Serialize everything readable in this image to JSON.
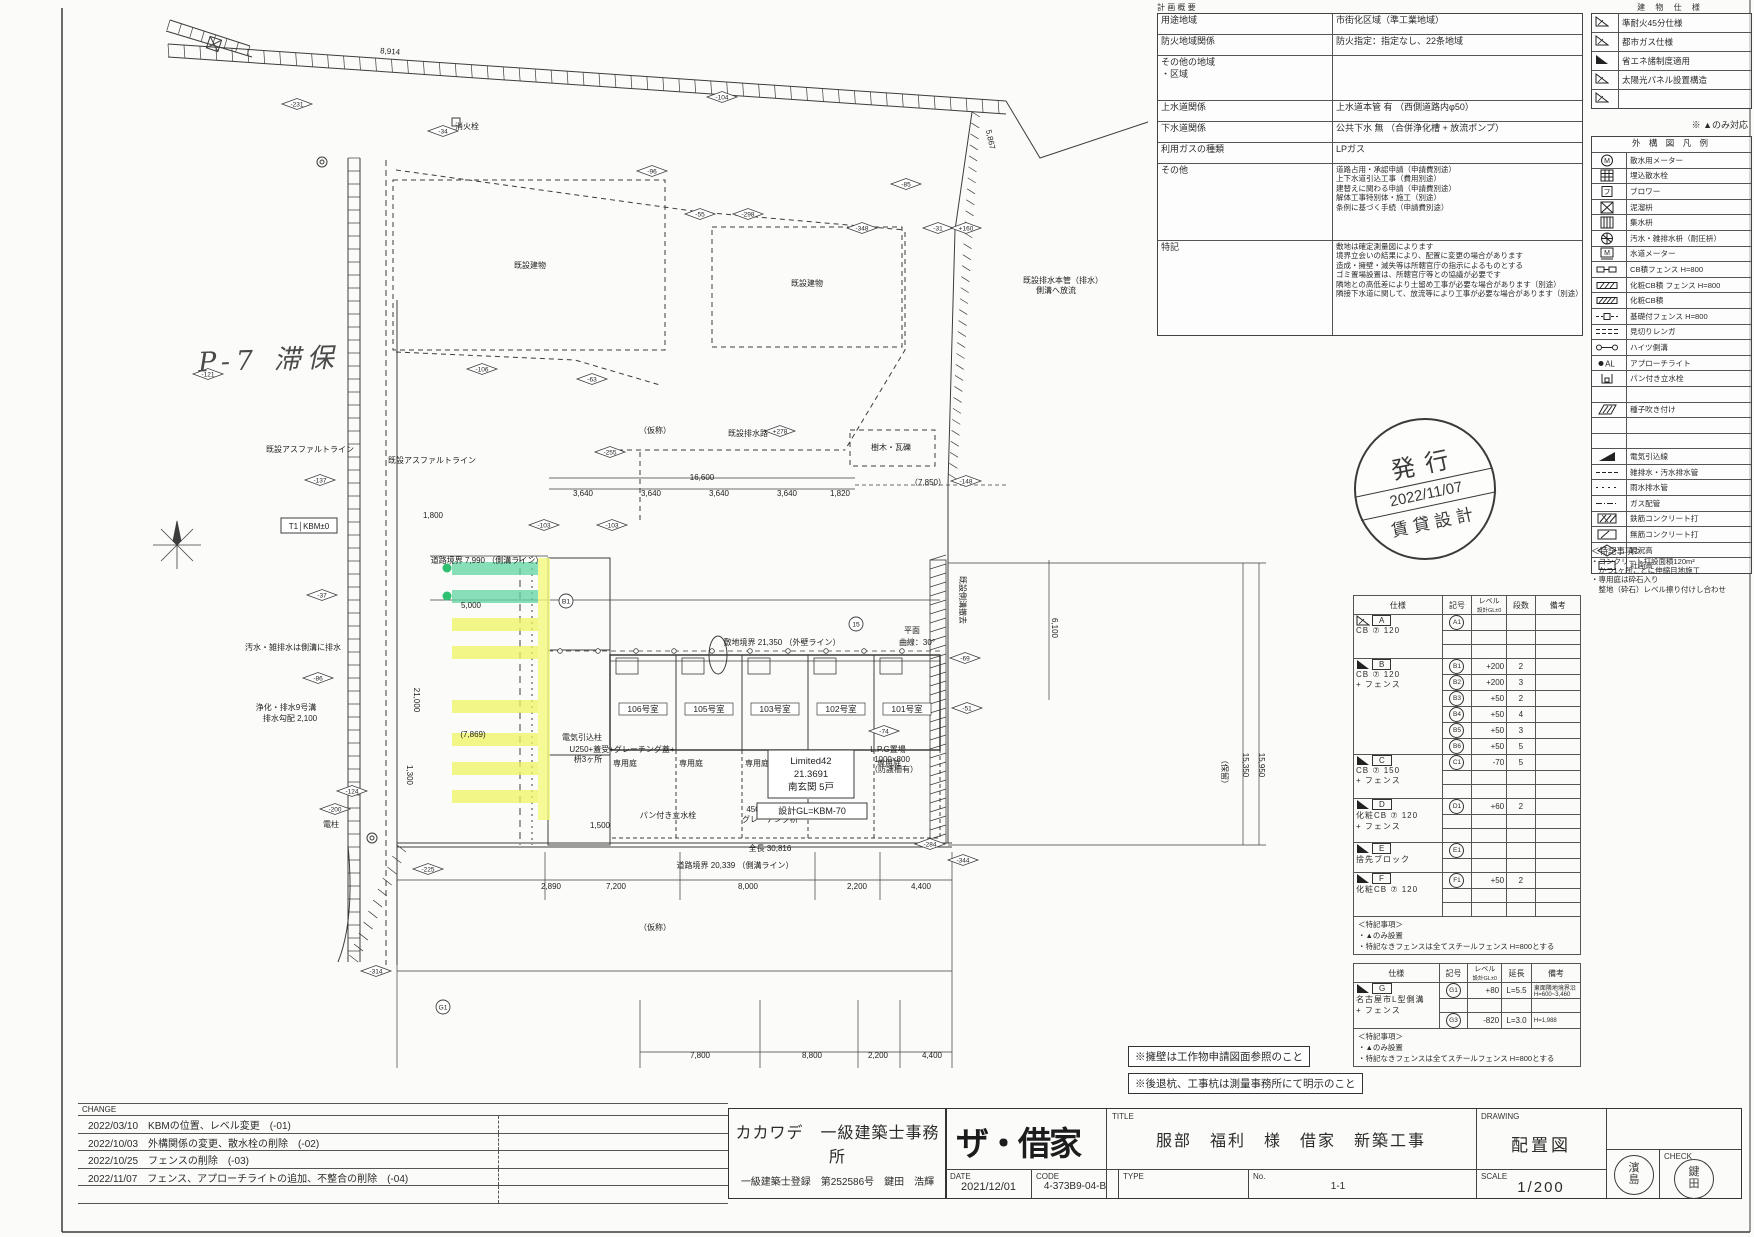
{
  "overview_table": {
    "title": "計 画 概 要",
    "rows": [
      {
        "label": "用途地域",
        "lines": [
          "市街化区域（準工業地域）"
        ]
      },
      {
        "label": "防火地域関係",
        "lines": [
          "防火指定：指定なし、22条地域"
        ]
      },
      {
        "label": "その他の地域\n・区域",
        "lines": []
      },
      {
        "label": "上水道関係",
        "lines": [
          "上水道本管 有 （西側道路内φ50）"
        ]
      },
      {
        "label": "下水道関係",
        "lines": [
          "公共下水 無 （合併浄化槽 + 放流ポンプ）"
        ]
      },
      {
        "label": "利用ガスの種類",
        "lines": [
          "LPガス"
        ]
      },
      {
        "label": "その他",
        "lines": [
          "道路占用・承認申請（申請費別途）",
          "上下水道引込工事（費用別途）",
          "建替えに関わる申請（申請費別途）",
          "解体工事特別体・施工（別途）",
          "条例に基づく手続（申請費別途）"
        ]
      },
      {
        "label": "特記",
        "lines": [
          "敷地は確定測量図によります",
          "境界立会いの結果により、配置に変更の場合があります",
          "造成・擁壁・滅失等は所轄官庁の指示によるものとする",
          "ゴミ置場設置は、所轄官庁等との協議が必要です",
          "隣地との高低差により土留め工事が必要な場合があります（別途）",
          "隣接下水道に関して、放流等により工事が必要な場合があります（別途）"
        ]
      }
    ]
  },
  "building_spec": {
    "title": "建 物 仕 様",
    "items": [
      {
        "mark": "hatch",
        "label": "準耐火45分仕様"
      },
      {
        "mark": "hatch",
        "label": "都市ガス仕様"
      },
      {
        "mark": "solid",
        "label": "省エネ諸制度適用"
      },
      {
        "mark": "hatch",
        "label": "太陽光パネル設置構造"
      },
      {
        "mark": "hatch",
        "label": ""
      }
    ],
    "note": "※ ▲のみ対応"
  },
  "legend": {
    "title": "外 構 図 凡 例",
    "rows": [
      {
        "icon": "meter-icon",
        "label": "散水用メーター"
      },
      {
        "icon": "sprinkler-icon",
        "label": "埋込散水栓"
      },
      {
        "icon": "blower-icon",
        "label": "ブロワー"
      },
      {
        "icon": "mud-basin-icon",
        "label": "泥溜枡"
      },
      {
        "icon": "catch-basin-icon",
        "label": "集水枡"
      },
      {
        "icon": "sewer-basin-icon",
        "label": "汚水・雑排水枡（耐圧枡）"
      },
      {
        "icon": "water-meter-icon",
        "label": "水道メーター"
      },
      {
        "icon": "cb-fence-icon",
        "label": "CB積フェンス H=800"
      },
      {
        "icon": "deco-cb-fence-icon",
        "label": "化粧CB積 フェンス H=800"
      },
      {
        "icon": "deco-cb-icon",
        "label": "化粧CB積"
      },
      {
        "icon": "base-fence-icon",
        "label": "基礎付フェンス H=800"
      },
      {
        "icon": "brick-edge-icon",
        "label": "見切りレンガ"
      },
      {
        "icon": "gutter-icon",
        "label": "ハイツ側溝"
      },
      {
        "icon": "approach-light-icon",
        "label": "アプローチライト"
      },
      {
        "icon": "faucet-icon",
        "label": "パン付き立水栓"
      },
      {
        "icon": "",
        "label": ""
      },
      {
        "icon": "seed-icon",
        "label": "種子吹き付け"
      },
      {
        "icon": "",
        "label": ""
      },
      {
        "icon": "",
        "label": ""
      },
      {
        "icon": "power-line-icon",
        "label": "電気引込線"
      },
      {
        "icon": "drain-pipe-icon",
        "label": "雑排水・汚水排水管"
      },
      {
        "icon": "rain-pipe-icon",
        "label": "雨水排水管"
      },
      {
        "icon": "gas-pipe-icon",
        "label": "ガス配管"
      },
      {
        "icon": "rc-icon",
        "label": "鉄筋コンクリート打"
      },
      {
        "icon": "plain-rc-icon",
        "label": "無筋コンクリート打"
      },
      {
        "icon": "existing-level-icon",
        "label": "現況高"
      },
      {
        "icon": "plan-level-icon",
        "label": "計画高"
      }
    ],
    "notes_title": "＜特記事項＞",
    "notes": [
      "・コンクリート打設面積120m²",
      "　かつ1ヶ所ごとに伸縮目地施工",
      "・専用庭は砕石入り",
      "　整地（砕石）レベル擦り付けし合わせ"
    ]
  },
  "issue_stamp": {
    "line1": "発行",
    "line2": "2022/11/07",
    "line3": "賃貸設計"
  },
  "spec_table": {
    "headers": [
      "仕様",
      "記号",
      "レベル|設計GL±0",
      "段数",
      "備考"
    ],
    "groups": [
      {
        "mark": "A",
        "tri": "hatch",
        "spec": [
          "CB ⑦ 120"
        ],
        "rows": [
          {
            "sym": "A1",
            "lv": "",
            "dan": "",
            "biko": []
          },
          {},
          {}
        ]
      },
      {
        "mark": "B",
        "tri": "solid",
        "spec": [
          "CB ⑦ 120",
          "+ フェンス"
        ],
        "rows": [
          {
            "sym": "B1",
            "lv": "+200",
            "dan": "2",
            "biko": []
          },
          {
            "sym": "B2",
            "lv": "+200",
            "dan": "3",
            "biko": []
          },
          {
            "sym": "B3",
            "lv": "+50",
            "dan": "2",
            "biko": []
          },
          {
            "sym": "B4",
            "lv": "+50",
            "dan": "4",
            "biko": []
          },
          {
            "sym": "B5",
            "lv": "+50",
            "dan": "3",
            "biko": []
          },
          {
            "sym": "B6",
            "lv": "+50",
            "dan": "5",
            "biko": []
          }
        ]
      },
      {
        "mark": "C",
        "tri": "solid",
        "spec": [
          "CB ⑦ 150",
          "+ フェンス"
        ],
        "rows": [
          {
            "sym": "C1",
            "lv": "-70",
            "dan": "5",
            "biko": []
          },
          {},
          {}
        ]
      },
      {
        "mark": "D",
        "tri": "solid",
        "spec": [
          "化粧CB ⑦ 120",
          "+ フェンス"
        ],
        "rows": [
          {
            "sym": "D1",
            "lv": "+60",
            "dan": "2",
            "biko": []
          },
          {},
          {}
        ]
      },
      {
        "mark": "E",
        "tri": "solid",
        "spec": [
          "捨先ブロック"
        ],
        "rows": [
          {
            "sym": "E1",
            "lv": "",
            "dan": "",
            "biko": []
          },
          {}
        ]
      },
      {
        "mark": "F",
        "tri": "solid",
        "spec": [
          "化粧CB ⑦ 120"
        ],
        "rows": [
          {
            "sym": "F1",
            "lv": "+50",
            "dan": "2",
            "biko": []
          },
          {},
          {}
        ]
      }
    ],
    "notes_title": "＜特記事項＞",
    "notes": [
      "・▲のみ設置",
      "・特記なきフェンスは全てスチールフェンス H=800とする"
    ]
  },
  "g_table": {
    "headers": [
      "仕様",
      "記号",
      "レベル|設計GL±0",
      "延長",
      "備考"
    ],
    "groups": [
      {
        "mark": "G",
        "tri": "solid",
        "spec": [
          "名古屋市L型側溝",
          "+ フェンス"
        ],
        "rows": [
          {
            "sym": "G1",
            "lv": "+80",
            "dan": "L=5.5",
            "biko": [
              "東面隣地境界沿",
              "H=600~3,460"
            ]
          },
          {},
          {
            "sym": "G3",
            "lv": "-820",
            "dan": "L=3.0",
            "biko": [
              "H=1,988"
            ]
          }
        ]
      }
    ],
    "notes_title": "＜特記事項＞",
    "notes": [
      "・▲のみ設置",
      "・特記なきフェンスは全てスチールフェンス H=800とする"
    ]
  },
  "note_boxes": [
    "※擁壁は工作物申請図面参照のこと",
    "※後退杭、工事杭は測量事務所にて明示のこと"
  ],
  "title_block": {
    "change_label": "CHANGE",
    "changes": [
      "2022/03/10　KBMの位置、レベル変更　(-01)",
      "2022/10/03　外構関係の変更、散水栓の削除　(-02)",
      "2022/10/25　フェンスの削除　(-03)",
      "2022/11/07　フェンス、アプローチライトの追加、不整合の削除　(-04)"
    ],
    "office_name": "カカワデ　一級建築士事務所",
    "office_reg": "一級建築士登録　第252586号　鍵田　浩輝",
    "logo": "ザ・借家",
    "title_label": "TITLE",
    "title": "服部　福利　様　借家　新築工事",
    "date_label": "DATE",
    "date": "2021/12/01",
    "code_label": "CODE",
    "code": "4-373B9-04-B",
    "type_label": "TYPE",
    "type": "",
    "no_label": "No.",
    "no": "1-1",
    "drawing_label": "DRAWING",
    "drawing": "配置図",
    "scale_label": "SCALE",
    "scale": "1/200",
    "check_label": "CHECK",
    "stamp_left": "濱島",
    "stamp_right": "鍵田"
  },
  "site_plan": {
    "handwriting": "P-7 滞保",
    "kbm_box": "T1│KBM±0",
    "room_labels": [
      "106号室",
      "105号室",
      "103号室",
      "102号室",
      "101号室"
    ],
    "yard_label": "専用庭",
    "building_info": [
      "Limited42",
      "21.3691",
      "南玄関 5戸"
    ],
    "gl_box": "設計GL=KBM-70",
    "colors": {
      "highlight_green": "#5fd6a0",
      "highlight_yellow": "#eef45f",
      "highlight_strip": "#f5fa7d",
      "line": "#3c3c3c"
    },
    "labels": [
      {
        "x": 310,
        "y": 452,
        "t": "既設アスファルトライン"
      },
      {
        "x": 432,
        "y": 463,
        "t": "既設アスファルトライン"
      },
      {
        "x": 530,
        "y": 268,
        "t": "既設建物"
      },
      {
        "x": 807,
        "y": 286,
        "t": "既設建物"
      },
      {
        "x": 655,
        "y": 433,
        "t": "（仮称）"
      },
      {
        "x": 748,
        "y": 436,
        "t": "既設排水路"
      },
      {
        "x": 891,
        "y": 450,
        "t": "樹木・瓦礫"
      },
      {
        "x": 467,
        "y": 129,
        "t": "消火栓"
      },
      {
        "x": 582,
        "y": 740,
        "t": "電気引込柱"
      },
      {
        "x": 622,
        "y": 752,
        "t": "U250+蓋受+グレーチング蓋+"
      },
      {
        "x": 588,
        "y": 762,
        "t": "枡3ヶ所"
      },
      {
        "x": 668,
        "y": 818,
        "t": "パン付き立水栓"
      },
      {
        "x": 762,
        "y": 812,
        "t": "450×450"
      },
      {
        "x": 770,
        "y": 822,
        "t": "グレーチング枡"
      },
      {
        "x": 888,
        "y": 752,
        "t": "L.P.G置場"
      },
      {
        "x": 892,
        "y": 762,
        "t": "1000×800"
      },
      {
        "x": 894,
        "y": 772,
        "t": "（防護柵有）"
      },
      {
        "x": 293,
        "y": 650,
        "t": "汚水・雑排水は側溝に排水"
      },
      {
        "x": 286,
        "y": 710,
        "t": "浄化・排水9号溝"
      },
      {
        "x": 290,
        "y": 721,
        "t": "排水勾配 2,100"
      },
      {
        "x": 960,
        "y": 600,
        "t": "既設側溝撤去",
        "rot": 90
      },
      {
        "x": 912,
        "y": 633,
        "t": "平面"
      },
      {
        "x": 917,
        "y": 645,
        "t": "曲線：30°"
      },
      {
        "x": 1063,
        "y": 283,
        "t": "既設排水本管（排水）"
      },
      {
        "x": 1056,
        "y": 293,
        "t": "側溝へ放流"
      },
      {
        "x": 331,
        "y": 827,
        "t": "電柱"
      },
      {
        "x": 655,
        "y": 930,
        "t": "（仮称）"
      }
    ],
    "dimensions": [
      {
        "x": 702,
        "y": 480,
        "t": "16,600"
      },
      {
        "x": 583,
        "y": 496,
        "t": "3,640"
      },
      {
        "x": 651,
        "y": 496,
        "t": "3,640"
      },
      {
        "x": 719,
        "y": 496,
        "t": "3,640"
      },
      {
        "x": 787,
        "y": 496,
        "t": "3,640"
      },
      {
        "x": 840,
        "y": 496,
        "t": "1,820"
      },
      {
        "x": 928,
        "y": 485,
        "t": "（7,850）"
      },
      {
        "x": 487,
        "y": 563,
        "t": "道路境界 7,990 （側溝ライン）"
      },
      {
        "x": 782,
        "y": 645,
        "t": "敷地境界 21,350 （外壁ライン）"
      },
      {
        "x": 770,
        "y": 851,
        "t": "全長 30,816"
      },
      {
        "x": 735,
        "y": 868,
        "t": "道路境界 20,339 （側溝ライン）"
      },
      {
        "x": 551,
        "y": 889,
        "t": "2,890"
      },
      {
        "x": 616,
        "y": 889,
        "t": "7,200"
      },
      {
        "x": 748,
        "y": 889,
        "t": "8,000"
      },
      {
        "x": 857,
        "y": 889,
        "t": "2,200"
      },
      {
        "x": 921,
        "y": 889,
        "t": "4,400"
      },
      {
        "x": 700,
        "y": 1058,
        "t": "7,800"
      },
      {
        "x": 812,
        "y": 1058,
        "t": "8,800"
      },
      {
        "x": 878,
        "y": 1058,
        "t": "2,200"
      },
      {
        "x": 932,
        "y": 1058,
        "t": "4,400"
      },
      {
        "x": 390,
        "y": 54,
        "t": "8,914",
        "rot": 4
      },
      {
        "x": 988,
        "y": 140,
        "t": "5,867",
        "rot": 78
      },
      {
        "x": 1243,
        "y": 765,
        "t": "15,350",
        "rot": 90
      },
      {
        "x": 1259,
        "y": 765,
        "t": "15,950",
        "rot": 90
      },
      {
        "x": 1222,
        "y": 772,
        "t": "（保留）",
        "rot": 90
      },
      {
        "x": 1052,
        "y": 628,
        "t": "6,100",
        "rot": 90
      },
      {
        "x": 433,
        "y": 518,
        "t": "1,800"
      },
      {
        "x": 414,
        "y": 700,
        "t": "21,000",
        "rot": 90
      },
      {
        "x": 471,
        "y": 608,
        "t": "5,000"
      },
      {
        "x": 473,
        "y": 737,
        "t": "(7,869)"
      },
      {
        "x": 407,
        "y": 775,
        "t": "1,300",
        "rot": 90
      },
      {
        "x": 600,
        "y": 828,
        "t": "1,500"
      }
    ],
    "spot_levels": [
      {
        "x": 297,
        "y": 104,
        "v": "-231"
      },
      {
        "x": 722,
        "y": 97,
        "v": "-104"
      },
      {
        "x": 443,
        "y": 131,
        "v": "-34"
      },
      {
        "x": 652,
        "y": 171,
        "v": "-96"
      },
      {
        "x": 700,
        "y": 214,
        "v": "-55"
      },
      {
        "x": 748,
        "y": 214,
        "v": "-298"
      },
      {
        "x": 862,
        "y": 228,
        "v": "-348"
      },
      {
        "x": 938,
        "y": 228,
        "v": "-31"
      },
      {
        "x": 966,
        "y": 228,
        "v": "+160"
      },
      {
        "x": 906,
        "y": 184,
        "v": "-85"
      },
      {
        "x": 208,
        "y": 374,
        "v": "-121"
      },
      {
        "x": 482,
        "y": 369,
        "v": "-106"
      },
      {
        "x": 592,
        "y": 379,
        "v": "-63"
      },
      {
        "x": 610,
        "y": 452,
        "v": "-255"
      },
      {
        "x": 780,
        "y": 431,
        "v": "+278"
      },
      {
        "x": 966,
        "y": 481,
        "v": "-148"
      },
      {
        "x": 544,
        "y": 525,
        "v": "-103"
      },
      {
        "x": 612,
        "y": 525,
        "v": "-103"
      },
      {
        "x": 965,
        "y": 658,
        "v": "-69"
      },
      {
        "x": 967,
        "y": 708,
        "v": "-51"
      },
      {
        "x": 884,
        "y": 731,
        "v": "-74"
      },
      {
        "x": 930,
        "y": 844,
        "v": "-284"
      },
      {
        "x": 352,
        "y": 791,
        "v": "-124"
      },
      {
        "x": 335,
        "y": 809,
        "v": "-200"
      },
      {
        "x": 428,
        "y": 869,
        "v": "-225"
      },
      {
        "x": 320,
        "y": 480,
        "v": "-137"
      },
      {
        "x": 322,
        "y": 595,
        "v": "-37"
      },
      {
        "x": 318,
        "y": 678,
        "v": "-86"
      },
      {
        "x": 963,
        "y": 860,
        "v": "-344"
      },
      {
        "x": 376,
        "y": 971,
        "v": "-314"
      }
    ],
    "circle_marks": [
      {
        "x": 856,
        "y": 624,
        "t": "15"
      },
      {
        "x": 566,
        "y": 601,
        "t": "B1"
      },
      {
        "x": 443,
        "y": 1007,
        "t": "G1"
      }
    ]
  }
}
